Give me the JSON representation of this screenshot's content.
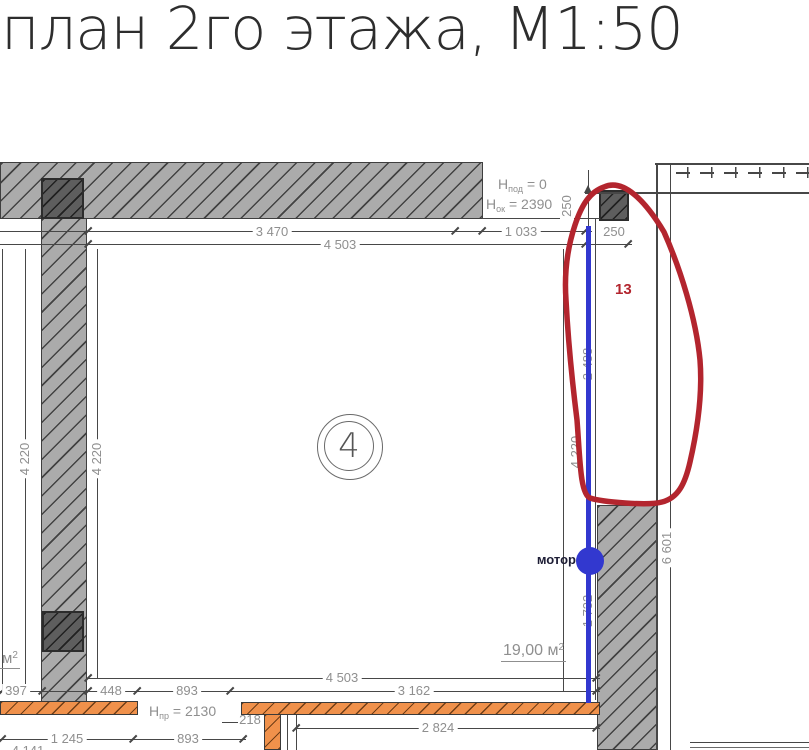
{
  "title": "план 2го этажа, М1:50",
  "room": {
    "number": "4",
    "area_value": "19,00 м",
    "area_sup": "2"
  },
  "adjacent_area": {
    "value": "м",
    "sup": "2"
  },
  "notes": {
    "h_pod": {
      "base": "H",
      "sub": "под",
      "rest": " = 0"
    },
    "h_ok": {
      "base": "H",
      "sub": "ок",
      "rest": " = 2390"
    },
    "h_pr": {
      "base": "H",
      "sub": "пр",
      "rest": " = 2130"
    },
    "motor": "мотор",
    "highlight": "13"
  },
  "dimensions": {
    "top_row1_a": "3 470",
    "top_row1_b": "1 033",
    "top_row1_c": "250",
    "top_row2": "4 503",
    "col_height": "250",
    "left_outer": "4 220",
    "left_inner": "4 220",
    "right_inner": "4 220",
    "right_outer": "6 601",
    "shaft_a": "2 488",
    "shaft_b": "1 732",
    "bot_row1": "4 503",
    "bot_row2_a": "397",
    "bot_row2_b": "448",
    "bot_row2_c": "893",
    "bot_row2_d": "3 162",
    "bot_row3": "2 824",
    "bot_row4_a": "1 245",
    "bot_row4_b": "893",
    "bot_partial": "4 141",
    "pillar": "218"
  },
  "colors": {
    "wall_gray": "#ababab",
    "column_gray": "#5e5e5e",
    "partition_orange": "#f0914b",
    "pipe_blue": "#3238cf",
    "annotation_red": "#b3252e",
    "dim_text_gray": "#8f8f8f"
  }
}
